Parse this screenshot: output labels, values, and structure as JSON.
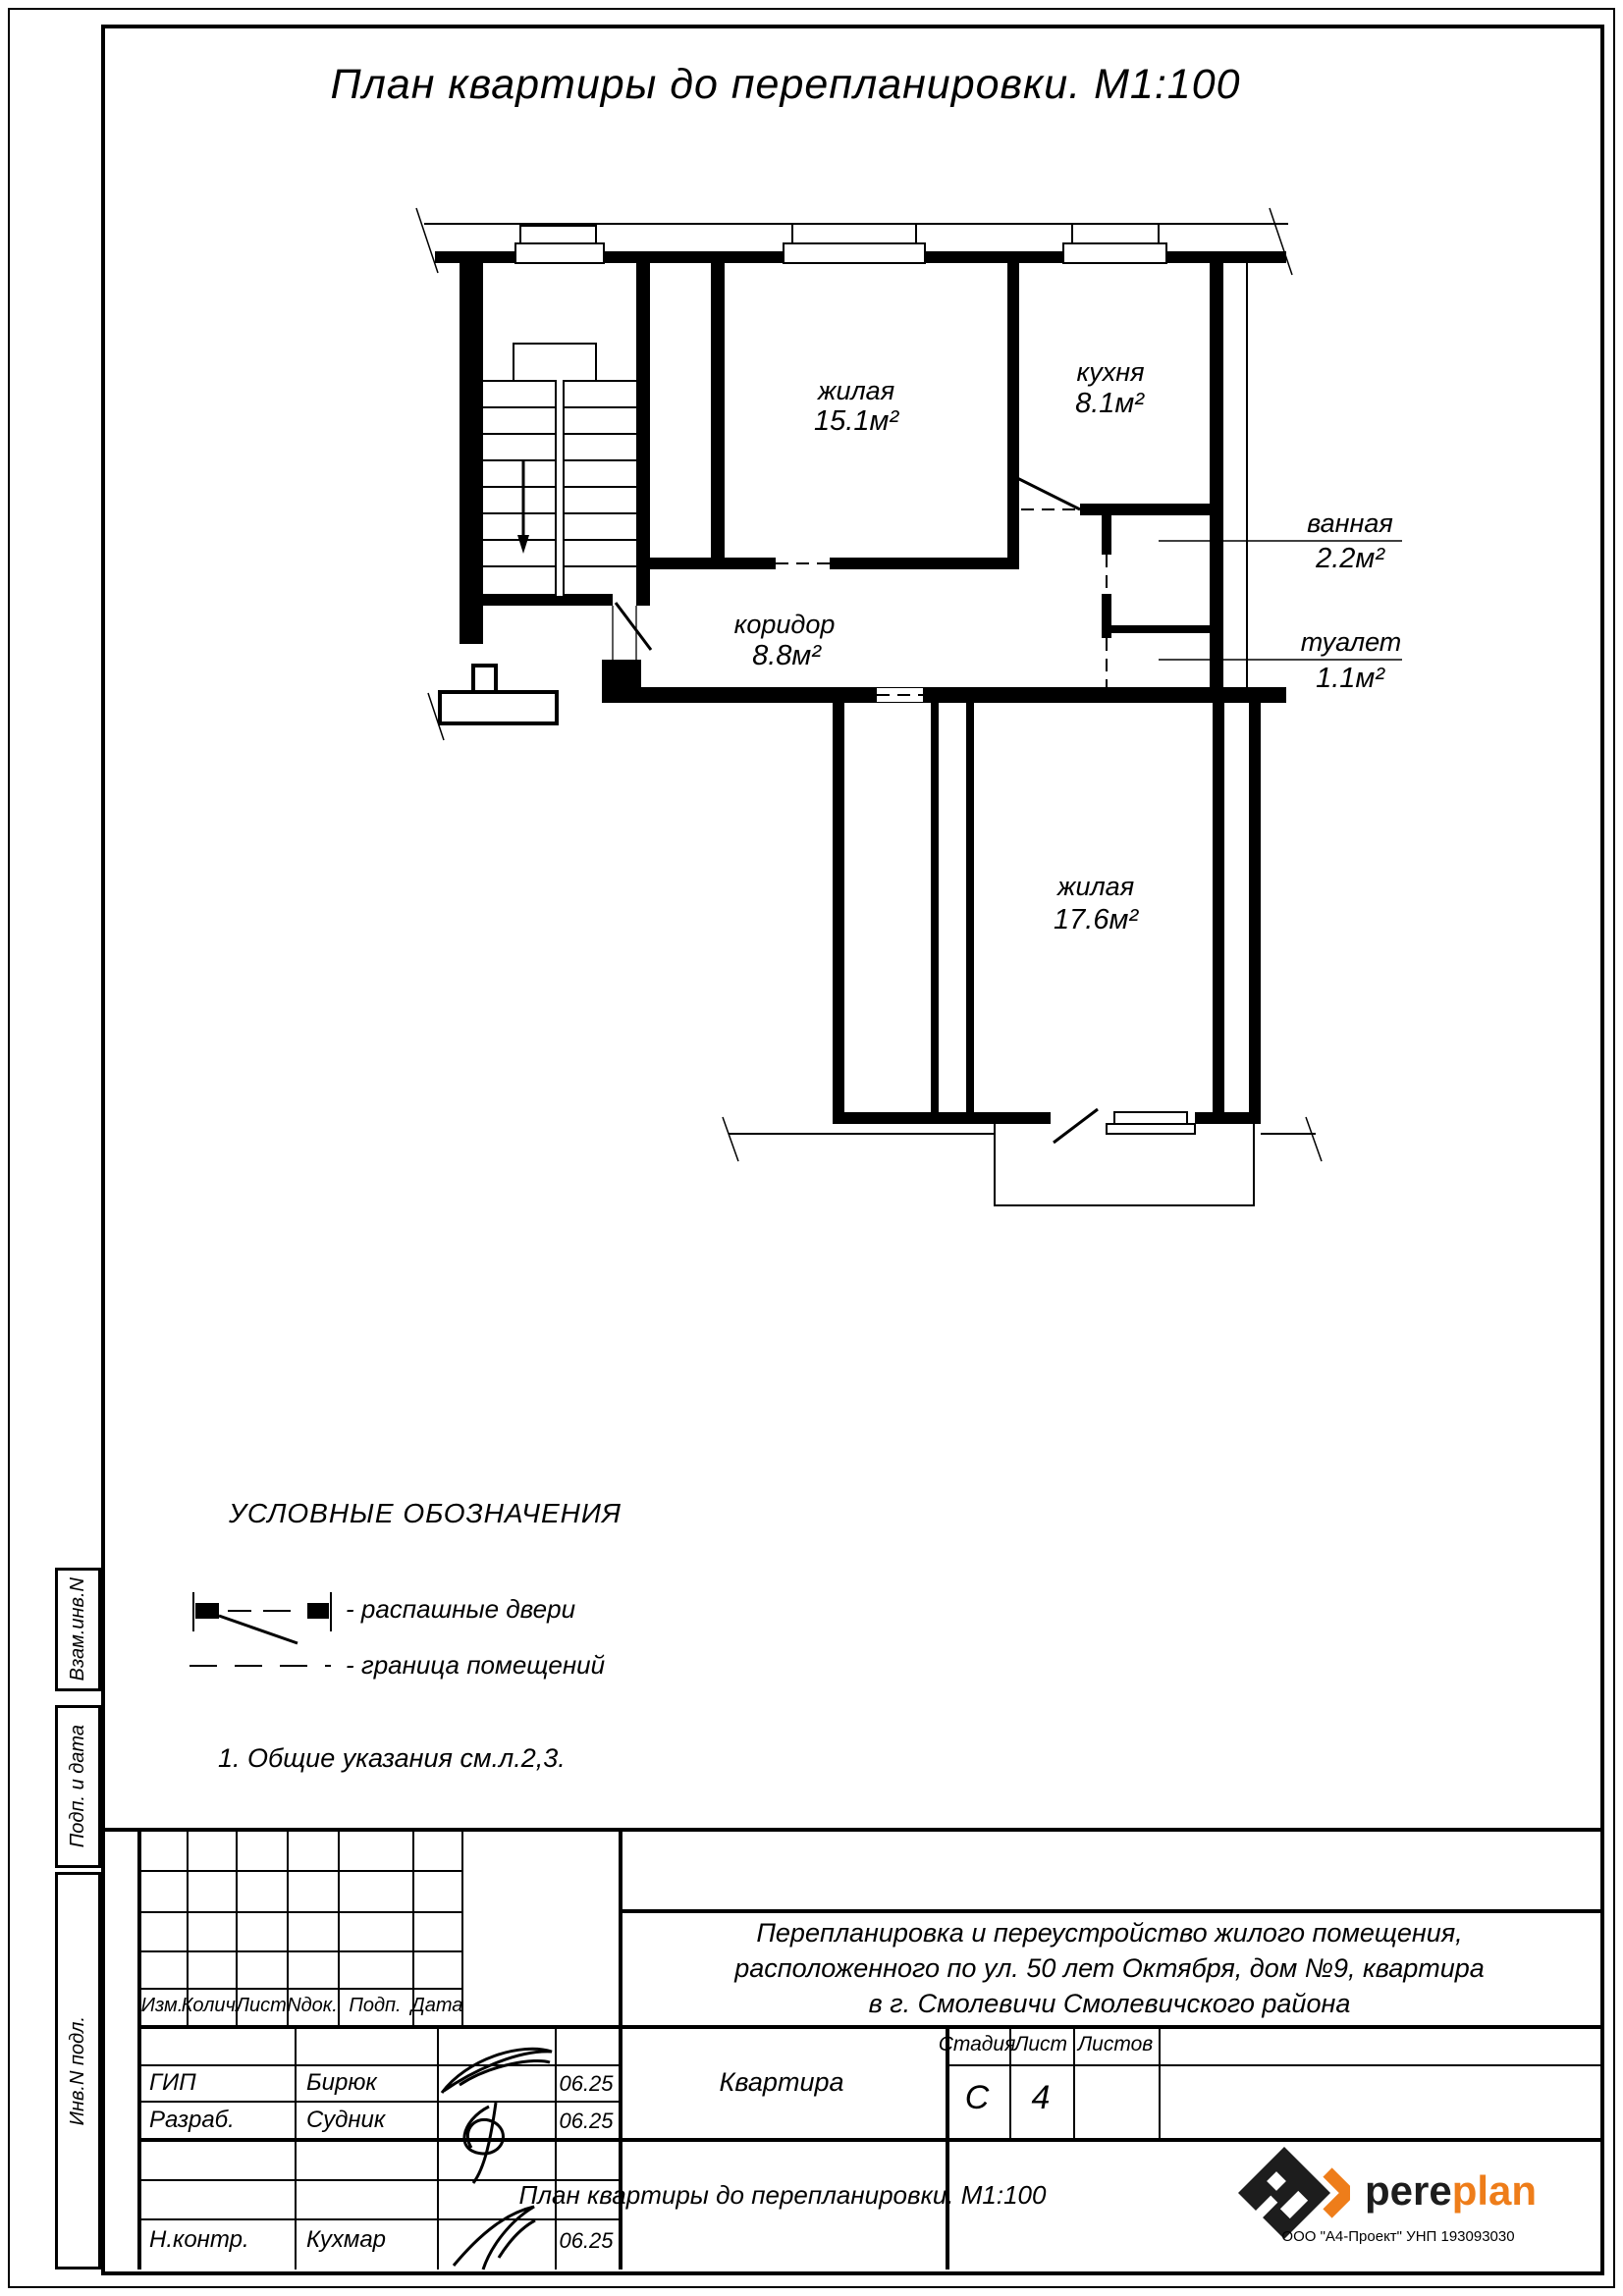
{
  "sheet": {
    "title": "План квартиры до перепланировки. М1:100"
  },
  "plan": {
    "rooms": [
      {
        "name": "жилая",
        "area": "15.1м²"
      },
      {
        "name": "кухня",
        "area": "8.1м²"
      },
      {
        "name": "коридор",
        "area": "8.8м²"
      },
      {
        "name": "ванная",
        "area": "2.2м²"
      },
      {
        "name": "туалет",
        "area": "1.1м²"
      },
      {
        "name": "жилая",
        "area": "17.6м²"
      }
    ]
  },
  "legend": {
    "heading": "УСЛОВНЫЕ ОБОЗНАЧЕНИЯ",
    "item_doors": "- распашные двери",
    "item_boundary": "- граница помещений",
    "note": "1. Общие указания см.л.2,3."
  },
  "sidebar": {
    "label_1": "Взам.инв.N",
    "label_2": "Подп. и дата",
    "label_3": "Инв.N подл."
  },
  "titleblock": {
    "col_izm": "Изм.",
    "col_kol": "Колич.",
    "col_list": "Лист",
    "col_ndok": "Nдок.",
    "col_podp": "Подп.",
    "col_data": "Дата",
    "row1_role": "ГИП",
    "row1_name": "Бирюк",
    "row1_date": "06.25",
    "row2_role": "Разраб.",
    "row2_name": "Судник",
    "row2_date": "06.25",
    "row3_role": "Н.контр.",
    "row3_name": "Кухмар",
    "row3_date": "06.25",
    "project_line1": "Перепланировка и переустройство жилого помещения,",
    "project_line2": "расположенного по ул. 50 лет Октября, дом №9, квартира",
    "project_line3": "в г. Смолевичи Смолевичского района",
    "object_name": "Квартира",
    "stage_label": "Стадия",
    "sheet_label": "Лист",
    "sheets_label": "Листов",
    "stage_value": "С",
    "sheet_value": "4",
    "drawing_name": "План квартиры до перепланировки. М1:100",
    "logo_part1": "pere",
    "logo_part2": "plan",
    "org_line": "ООО \"А4-Проект\" УНП 193093030",
    "accent_color": "#EE7D1A"
  }
}
